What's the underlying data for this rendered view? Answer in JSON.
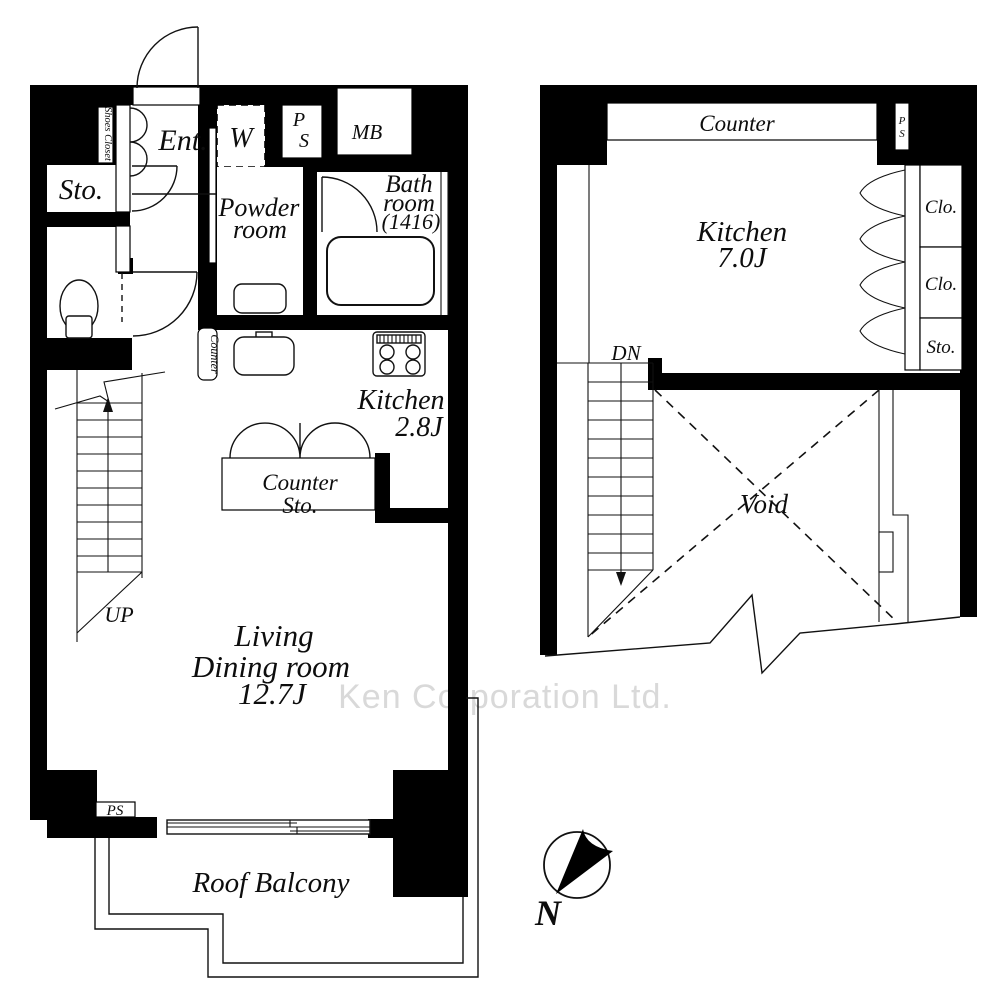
{
  "watermark": "Ken Corporation Ltd.",
  "floor1": {
    "shoes_closet": "Shoes Closet",
    "ent": "Ent.",
    "sto": "Sto.",
    "washer": "W",
    "ps_p": "P",
    "ps_s": "S",
    "mb": "MB",
    "powder_1": "Powder",
    "powder_2": "room",
    "bath_1": "Bath",
    "bath_2": "room",
    "bath_3": "(1416)",
    "counter_side": "Counter",
    "kitchen_1": "Kitchen",
    "kitchen_2": "2.8J",
    "counter_sto_1": "Counter",
    "counter_sto_2": "Sto.",
    "up": "UP",
    "living_1": "Living",
    "living_2": "Dining room",
    "living_3": "12.7J",
    "ps_bottom": "PS",
    "roof_balcony": "Roof Balcony"
  },
  "floor2": {
    "counter": "Counter",
    "ps_p": "P",
    "ps_s": "S",
    "kitchen_1": "Kitchen",
    "kitchen_2": "7.0J",
    "clo_1": "Clo.",
    "clo_2": "Clo.",
    "sto": "Sto.",
    "dn": "DN",
    "void": "Void"
  },
  "compass": {
    "north": "N"
  },
  "colors": {
    "wall": "#000000",
    "line": "#111111",
    "watermark": "#d9d9d9"
  }
}
